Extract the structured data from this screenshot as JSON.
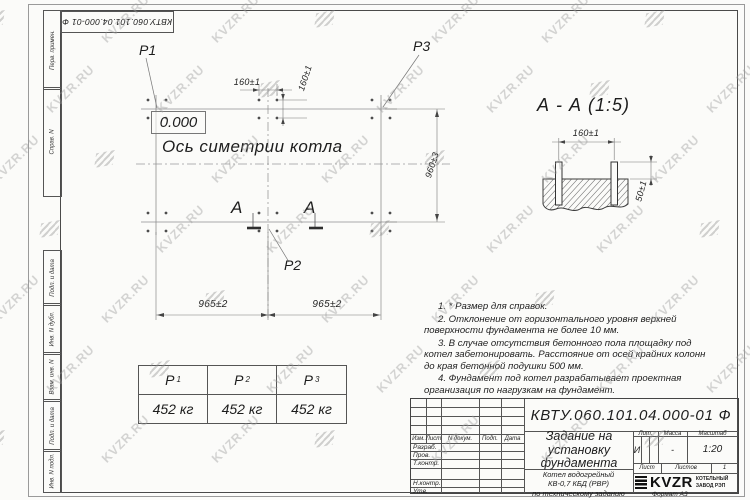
{
  "watermark": {
    "text": "KVZR.RU"
  },
  "frame": {
    "top_stamp": "КВТУ.060.101.04.000-01  Ф",
    "margin_labels": {
      "perv_primen": "Перв. примен.",
      "sprav_n": "Справ. N",
      "podp_data_1": "Подп. и дата",
      "inv_n_dubl": "Инв. N дубл.",
      "vzam_inv_n": "Взам. инв. N",
      "podp_data_2": "Подп. и дата",
      "inv_n_podl": "Инв. N подл.",
      "format": "Формат А3"
    }
  },
  "plan": {
    "labels": {
      "p1": "P1",
      "p2": "P2",
      "p3": "P3"
    },
    "level_mark": "0.000",
    "axis_label": "Ось симетрии котла",
    "dims": {
      "top_horizontal": "160±1",
      "top_vertical": "160±1",
      "right_vertical": "960±3",
      "bottom_left": "965±2",
      "bottom_right": "965±2"
    },
    "section_letters": {
      "left": "А",
      "right": "А"
    }
  },
  "section_view": {
    "title": "А - А (1:5)",
    "dims": {
      "bolt_spacing": "160±1",
      "bolt_height": "50±1"
    }
  },
  "load_table": {
    "columns": [
      {
        "label": "P",
        "sub": "1",
        "value": "452 кг"
      },
      {
        "label": "P",
        "sub": "2",
        "value": "452 кг"
      },
      {
        "label": "P",
        "sub": "3",
        "value": "452 кг"
      }
    ]
  },
  "notes": [
    "1. * Размер для справок.",
    "2. Отклонение от горизонтального уровня верхней поверхности фундамента не более 10 мм.",
    "3. В случае отсутствия бетонного пола площадку под котел забетонировать. Расстояние от осей крайних колонн до края бетонной подушки 500 мм.",
    "4. Фундамент под котел разрабатывает проектная организация по нагрузкам на фундамент."
  ],
  "title_block": {
    "doc_number": "КВТУ.060.101.04.000-01 Ф",
    "title": "Задание на установку фундамента",
    "product_lines": [
      "Котел водогрейный",
      "КВ-0,7 КБД (РВР)",
      "по техническому заданию"
    ],
    "header_cols": {
      "izm": "Изм.",
      "list": "Лист",
      "ndoc": "N докум.",
      "podp": "Подп.",
      "data": "Дата"
    },
    "rows": {
      "razrab": "Разраб.",
      "prov": "Пров.",
      "tkontr": "Т.контр.",
      "nkontr": "Н.контр.",
      "utv": "Утв."
    },
    "lit": {
      "label": "Лит.",
      "value": "И"
    },
    "mass": {
      "label": "Масса",
      "value": "-"
    },
    "scale": {
      "label": "Масштаб",
      "value": "1:20"
    },
    "sheet": {
      "label": "Лист",
      "sheets_label": "Листов",
      "sheets_value": "1"
    },
    "logo": {
      "text": "KVZR",
      "line1": "КОТЕЛЬНЫЙ",
      "line2": "ЗАВОД РЭП"
    }
  }
}
